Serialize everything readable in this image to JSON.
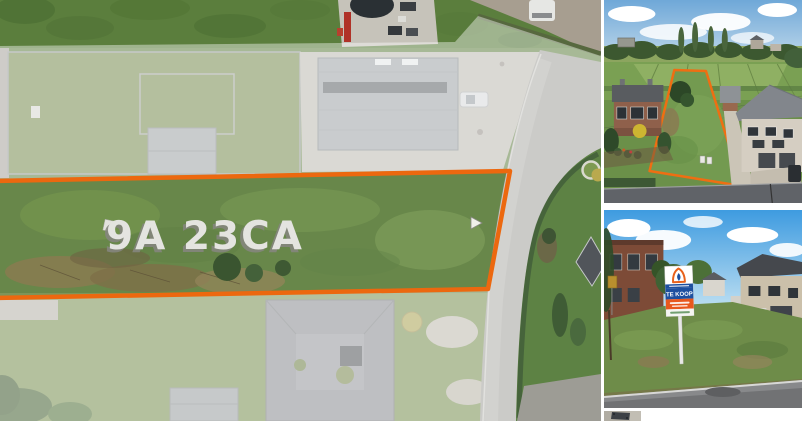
{
  "page": {
    "background_color": "#FFFFFF"
  },
  "main_photo": {
    "plot_area_label": "9A 23CA",
    "outline_color": "#EC680F"
  },
  "thumb_top": {
    "outline_color": "#EF6E12"
  },
  "thumb_street": {
    "sign_text": "TE KOOP",
    "sign_blue": "#1D4F9F",
    "sign_orange": "#E8581D"
  }
}
